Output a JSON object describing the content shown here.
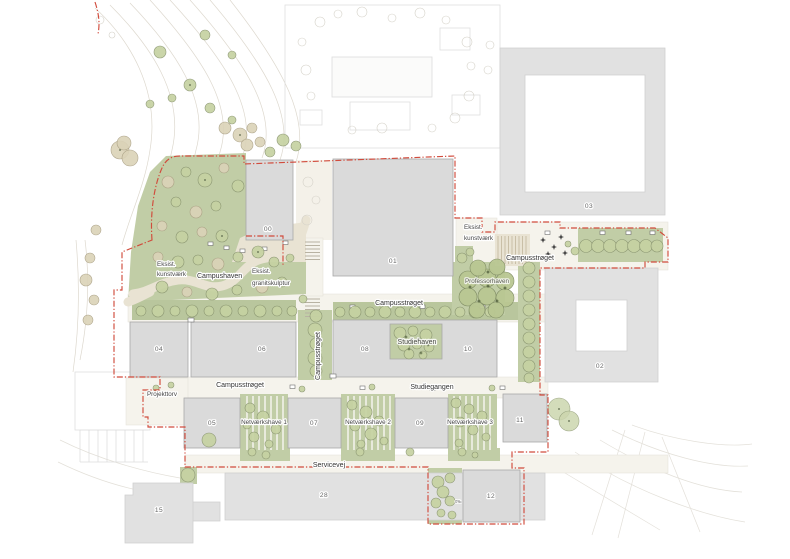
{
  "plan": {
    "labels": {
      "eksist": "Eksist.",
      "kunstvaerk": "kunstværk",
      "granitskulptur": "granitskulptur",
      "campushaven": "Campushaven",
      "campusstroget": "Campusstrøget",
      "studiehaven": "Studiehaven",
      "studiegangen": "Studiegangen",
      "professorhaven": "Professorhaven",
      "netvaerkshave1": "Netværkshave 1",
      "netvaerkshave2": "Netværkshave 2",
      "netvaerkshave3": "Netværkshave 3",
      "projekttorv": "Projekttorv",
      "servicevej": "Servicevej",
      "slope": "0‰"
    },
    "buildings": [
      {
        "label": "00"
      },
      {
        "label": "01"
      },
      {
        "label": "02"
      },
      {
        "label": "03"
      },
      {
        "label": "04"
      },
      {
        "label": "05"
      },
      {
        "label": "06"
      },
      {
        "label": "07"
      },
      {
        "label": "08"
      },
      {
        "label": "09"
      },
      {
        "label": "10"
      },
      {
        "label": "11"
      },
      {
        "label": "12"
      },
      {
        "label": "15"
      },
      {
        "label": "28"
      }
    ],
    "colors": {
      "boundary_red": "#d14b3c",
      "green_area": "#c1cda6",
      "new_building_gray": "#dadada",
      "existing_building_gray": "#e1e1e1",
      "gravel_beige": "#e9e3d3",
      "tree_green": "#c6d2a2",
      "tree_beige": "#dbd3b8"
    }
  }
}
